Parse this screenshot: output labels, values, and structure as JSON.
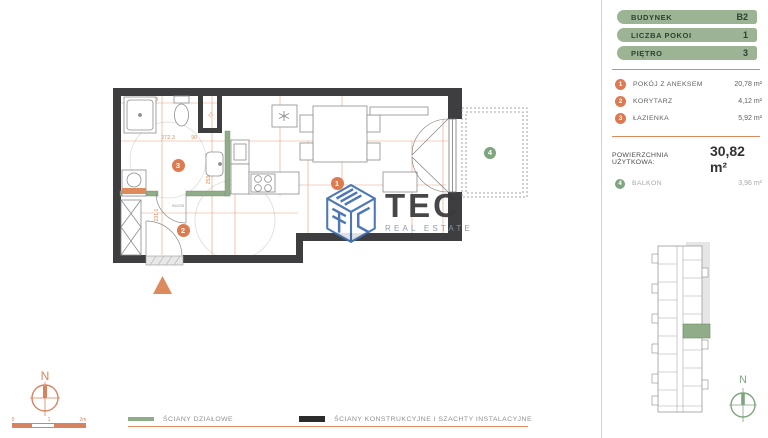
{
  "sidebar": {
    "info_rows": [
      {
        "label": "BUDYNEK",
        "value": "B2"
      },
      {
        "label": "LICZBA POKOI",
        "value": "1"
      },
      {
        "label": "PIĘTRO",
        "value": "3"
      }
    ],
    "rooms": [
      {
        "num": "1",
        "name": "POKÓJ Z ANEKSEM",
        "area": "20,78 m²"
      },
      {
        "num": "2",
        "name": "KORYTARZ",
        "area": "4,12 m²"
      },
      {
        "num": "3",
        "name": "ŁAZIENKA",
        "area": "5,92 m²"
      }
    ],
    "total": {
      "label": "POWIERZCHNIA UŻYTKOWA:",
      "value": "30,82 m²"
    },
    "balcony_row": {
      "num": "4",
      "name": "BALKON",
      "area": "3,96 m²"
    }
  },
  "plan": {
    "markers": {
      "room": "1",
      "corridor": "2",
      "bath": "3",
      "balcony": "4"
    },
    "dims": {
      "bath_top": "261.3",
      "bath_w": "272.3",
      "bath_w2": "90",
      "room_w": "377.5",
      "v_corridor": "231.1",
      "v_kitchen": "253.5",
      "v_room": "155.5",
      "shaft": "72",
      "door": "90/205"
    }
  },
  "legend": {
    "items": [
      {
        "label": "ŚCIANY DZIAŁOWE"
      },
      {
        "label": "ŚCIANY KONSTRUKCYJNE I SZACHTY INSTALACYJNE"
      }
    ]
  },
  "logo": {
    "title": "TEC",
    "subtitle": "REAL ESTATE"
  },
  "compass": {
    "label": "N"
  },
  "minimap_compass": {
    "label": "N"
  },
  "scale_bar": {
    "ticks": [
      "0",
      "1",
      "2m"
    ]
  },
  "colors": {
    "accent_orange": "#dd7a50",
    "dim_orange": "#e08a5f",
    "wall_dark": "#3e3e40",
    "partition_green": "#8fae88",
    "sidebar_green": "#9cb394",
    "logo_blue": "#3f6eb0"
  }
}
